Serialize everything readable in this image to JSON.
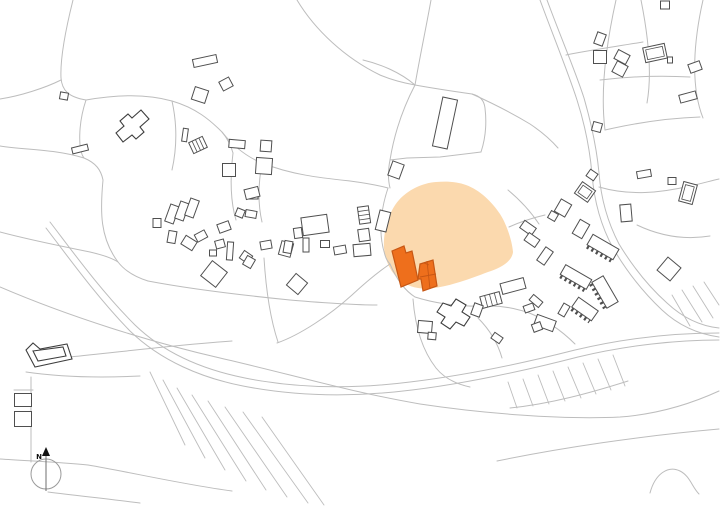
{
  "title": "Village site plan with highlighted project site",
  "canvas": {
    "width": 720,
    "height": 510
  },
  "colors": {
    "background": "#ffffff",
    "parcel_line": "#bdbdbd",
    "building_stroke": "#4f4f4f",
    "building_fill": "#ffffff",
    "special_stroke": "#3d3d3d",
    "site_fill": "#fbd9ae",
    "highlight_fill": "#ee6f1c",
    "highlight_stroke": "#c75714",
    "north_circle": "#9a9a9a",
    "north_needle": "#6f6f6f",
    "north_mark": "#111111"
  },
  "north": {
    "label": "N",
    "cx": 46,
    "cy": 474,
    "r": 15
  },
  "map": {
    "site_path": "M399,200 C408,190 422,183 436,182 C448,181 458,182 466,185 C480,190 492,202 500,214 C506,223 512,240 513,252 C512,262 500,268 488,272 C470,279 450,286 434,288 C420,290 408,287 400,280 C390,272 385,260 384,248 C383,234 388,212 399,200 Z",
    "lines": [
      "M73,0 C66,28 60,58 61,78 C62,90 68,97 86,100",
      "M86,100 C120,94 148,94 172,101 C196,108 210,120 222,132 C228,139 231,146 233,153",
      "M61,80 C45,88 20,96 0,99",
      "M0,146 C25,150 55,149 84,158",
      "M86,100 C78,124 78,150 84,158",
      "M84,158 C96,163 101,170 103,180 C100,212 100,238 118,262 C125,271 135,277 148,281",
      "M0,232 C30,240 60,246 90,252 C103,255 112,258 118,262",
      "M148,281 C190,289 240,295 290,300 C325,303 355,305 377,305",
      "M172,101 C178,128 176,152 172,170",
      "M222,132 C234,147 247,157 262,163 C292,175 322,178 350,181 C365,183 377,185 388,188",
      "M233,153 C230,178 230,200 236,220",
      "M262,163 C258,185 258,205 262,222",
      "M297,0 C315,30 345,58 380,75 C392,80 404,83 415,85",
      "M415,85 C400,72 380,64 363,60",
      "M415,85 C420,56 426,28 431,0",
      "M415,85 C402,110 394,135 390,160 C388,170 388,180 390,188",
      "M390,160 L407,158 L440,157 L473,153 L481,152",
      "M415,85 C437,89 458,92 472,94 C480,96 484,100 485,108 C487,125 485,140 481,152",
      "M472,94 C492,103 512,113 530,124 C542,132 551,140 558,148",
      "M509,227 C520,222 532,218 545,215",
      "M540,0 C554,38 568,72 577,100 C586,128 590,152 592,174 C594,200 601,226 613,248 C627,272 644,293 662,310 C678,325 698,334 719,337",
      "M547,0 C561,38 575,70 584,98 C592,126 597,151 599,173 C601,199 608,223 619,244 C633,267 649,287 667,303 C682,317 700,326 719,328",
      "M50,222 C70,248 100,290 135,325 C165,354 205,370 245,378 C300,389 355,389 410,382 C460,376 520,364 575,350 C625,338 675,333 719,333",
      "M46,228 C66,254 96,296 130,331 C161,361 202,378 243,386 C299,397 356,397 412,390 C462,384 524,371 578,357 C628,345 678,340 719,340",
      "M0,287 C70,317 150,342 220,358 C290,374 350,392 420,404 C480,413 560,420 620,417 C660,414 695,402 719,391",
      "M497,461 C560,448 640,436 719,429",
      "M650,493 C655,474 668,465 680,471 C690,476 692,487 699,494",
      "M0,459 C30,461 60,462 88,465 C130,472 180,484 232,491",
      "M31,377 L31,462",
      "M14,390 L33,390",
      "M70,357 C120,352 175,345 232,341",
      "M26,372 C60,377 100,378 140,376",
      "M48,492 C80,496 110,499 140,503",
      "M616,0 C606,45 600,90 605,130",
      "M641,0 C649,40 652,75 647,103",
      "M703,0 C694,40 690,85 703,118",
      "M566,55 C590,50 620,46 643,42",
      "M600,80 C625,77 655,75 690,77",
      "M605,130 C640,122 670,118 700,117",
      "M599,187 C630,196 660,193 690,186 C700,184 710,181 719,179",
      "M637,225 C660,236 685,240 710,236",
      "M264,258 C266,290 270,318 278,342",
      "M277,343 C300,335 330,315 352,295 C365,283 378,272 390,264",
      "M388,188 C380,212 378,236 386,258 C387,260 388,262 390,264",
      "M390,264 C396,278 404,290 415,297",
      "M415,297 C440,305 465,307 490,306 C505,306 516,309 527,312",
      "M413,299 C415,325 422,350 436,368 C444,378 456,384 470,387",
      "M478,318 C490,330 498,344 502,358",
      "M508,190 C520,200 531,212 539,224",
      "M527,312 C547,320 562,331 575,344",
      "M510,408 C550,404 590,393 628,381"
    ],
    "strips": [
      "M150,372 L185,445",
      "M163,380 L205,458",
      "M177,388 L225,470",
      "M192,395 L246,481",
      "M208,401 L266,490",
      "M225,407 L287,497",
      "M243,412 L308,503",
      "M262,417 L324,505",
      "M508,382 L517,408",
      "M523,379 L533,406",
      "M538,375 L549,404",
      "M553,371 L565,401",
      "M568,367 L581,398",
      "M583,363 L596,394",
      "M598,359 L611,390",
      "M613,355 L625,386",
      "M672,295 L690,326",
      "M682,290 L702,322",
      "M693,286 L713,318",
      "M704,282 L719,305"
    ],
    "buildings": [
      [
        205,
        61,
        24,
        8,
        -12
      ],
      [
        226,
        84,
        11,
        10,
        -28
      ],
      [
        200,
        95,
        14,
        13,
        18
      ],
      [
        80,
        149,
        16,
        6,
        -14
      ],
      [
        64,
        96,
        8,
        7,
        10
      ],
      [
        172,
        214,
        9,
        18,
        20
      ],
      [
        182,
        211,
        9,
        18,
        20
      ],
      [
        192,
        208,
        9,
        18,
        20
      ],
      [
        157,
        223,
        8,
        9,
        0
      ],
      [
        172,
        237,
        8,
        12,
        10
      ],
      [
        189,
        243,
        13,
        10,
        32
      ],
      [
        201,
        236,
        11,
        8,
        -28
      ],
      [
        224,
        227,
        12,
        9,
        -20
      ],
      [
        220,
        244,
        9,
        8,
        -15
      ],
      [
        230,
        251,
        6,
        18,
        4
      ],
      [
        213,
        253,
        7,
        6,
        0
      ],
      [
        214,
        274,
        19,
        19,
        38
      ],
      [
        240,
        213,
        8,
        8,
        22
      ],
      [
        251,
        214,
        11,
        7,
        10
      ],
      [
        253,
        195,
        10,
        8,
        0
      ],
      [
        246,
        257,
        10,
        9,
        35
      ],
      [
        266,
        245,
        11,
        8,
        -10
      ],
      [
        286,
        249,
        12,
        14,
        15
      ],
      [
        249,
        262,
        9,
        10,
        30
      ],
      [
        297,
        284,
        15,
        15,
        40
      ],
      [
        340,
        250,
        12,
        8,
        -10
      ],
      [
        362,
        250,
        17,
        12,
        -5
      ],
      [
        315,
        225,
        26,
        18,
        -8
      ],
      [
        298,
        233,
        8,
        10,
        -8
      ],
      [
        306,
        245,
        6,
        14,
        0
      ],
      [
        288,
        247,
        8,
        12,
        10
      ],
      [
        325,
        244,
        9,
        7,
        0
      ],
      [
        266,
        146,
        11,
        11,
        4
      ],
      [
        264,
        166,
        16,
        16,
        4
      ],
      [
        229,
        170,
        13,
        13,
        0
      ],
      [
        237,
        144,
        16,
        8,
        5
      ],
      [
        252,
        193,
        14,
        10,
        -14
      ],
      [
        185,
        135,
        5,
        13,
        8
      ],
      [
        198,
        145,
        15,
        12,
        -25,
        "s"
      ],
      [
        364,
        215,
        11,
        17,
        -8,
        "s"
      ],
      [
        364,
        235,
        11,
        12,
        -8
      ],
      [
        383,
        221,
        11,
        20,
        14
      ],
      [
        396,
        170,
        12,
        15,
        20
      ],
      [
        445,
        123,
        15,
        50,
        12
      ],
      [
        528,
        228,
        14,
        9,
        35
      ],
      [
        532,
        240,
        13,
        9,
        35
      ],
      [
        545,
        256,
        9,
        16,
        35
      ],
      [
        563,
        208,
        12,
        14,
        30
      ],
      [
        553,
        216,
        8,
        8,
        30
      ],
      [
        581,
        229,
        11,
        16,
        30
      ],
      [
        585,
        192,
        16,
        14,
        35,
        "i"
      ],
      [
        592,
        175,
        9,
        8,
        35
      ],
      [
        626,
        213,
        11,
        17,
        -5
      ],
      [
        644,
        174,
        14,
        7,
        -10
      ],
      [
        672,
        181,
        8,
        7,
        0
      ],
      [
        688,
        193,
        14,
        20,
        15,
        "i"
      ],
      [
        669,
        269,
        17,
        17,
        40
      ],
      [
        513,
        286,
        24,
        11,
        -15
      ],
      [
        491,
        300,
        20,
        12,
        -15,
        "s"
      ],
      [
        536,
        301,
        12,
        7,
        40
      ],
      [
        564,
        310,
        7,
        12,
        30
      ],
      [
        545,
        323,
        20,
        11,
        20
      ],
      [
        537,
        327,
        9,
        8,
        -20
      ],
      [
        425,
        327,
        14,
        12,
        5
      ],
      [
        432,
        336,
        8,
        7,
        5
      ],
      [
        477,
        310,
        9,
        12,
        20
      ],
      [
        497,
        338,
        10,
        7,
        35
      ],
      [
        529,
        308,
        10,
        7,
        -20
      ],
      [
        600,
        39,
        9,
        12,
        20
      ],
      [
        600,
        57,
        13,
        13,
        0
      ],
      [
        622,
        57,
        13,
        10,
        28
      ],
      [
        620,
        69,
        12,
        12,
        28
      ],
      [
        655,
        53,
        22,
        15,
        -12,
        "i"
      ],
      [
        670,
        60,
        5,
        6,
        0
      ],
      [
        695,
        67,
        12,
        9,
        -20
      ],
      [
        688,
        97,
        17,
        8,
        -15
      ],
      [
        665,
        5,
        9,
        8,
        0
      ],
      [
        597,
        127,
        9,
        9,
        15
      ],
      [
        23,
        400,
        17,
        13,
        0
      ],
      [
        23,
        419,
        17,
        15,
        0
      ],
      [
        576,
        277,
        30,
        11,
        30,
        "t"
      ],
      [
        603,
        247,
        30,
        12,
        30,
        "t"
      ],
      [
        605,
        292,
        30,
        13,
        60,
        "t"
      ],
      [
        585,
        309,
        24,
        12,
        35,
        "t"
      ]
    ],
    "special_buildings": [
      {
        "name": "cross-building-church",
        "path": "M116,133 L124,126 L120,121 L128,114 L132,118 L141,110 L149,119 L140,127 L144,132 L136,139 L132,135 L123,142 Z",
        "fill": true
      },
      {
        "name": "cross-building-south",
        "path": "M437,312 L443,303 L451,306 L456,299 L466,305 L462,312 L470,317 L464,326 L456,322 L450,329 L441,323 L445,317 Z",
        "fill": true
      },
      {
        "name": "l-building-outer",
        "path": "M26,350 L33,343 L40,349 L67,344 L72,359 L35,367 Z",
        "fill": true
      },
      {
        "name": "l-building-inner",
        "path": "M33,351 L63,347 L66,356 L38,361 Z",
        "fill": false
      }
    ],
    "highlight_buildings": [
      {
        "name": "project-building-west",
        "path": "M392,251 L404,246 L406,253 L412,251 L418,280 L401,287 Z"
      },
      {
        "name": "project-building-east",
        "path": "M420,264 L433,260 L437,286 L423,291 L421,279 L418,279 Z"
      }
    ],
    "highlight_details": [
      "M427,261 L430,289",
      "M420,277 L436,274",
      "M424,263 L429,265"
    ]
  }
}
